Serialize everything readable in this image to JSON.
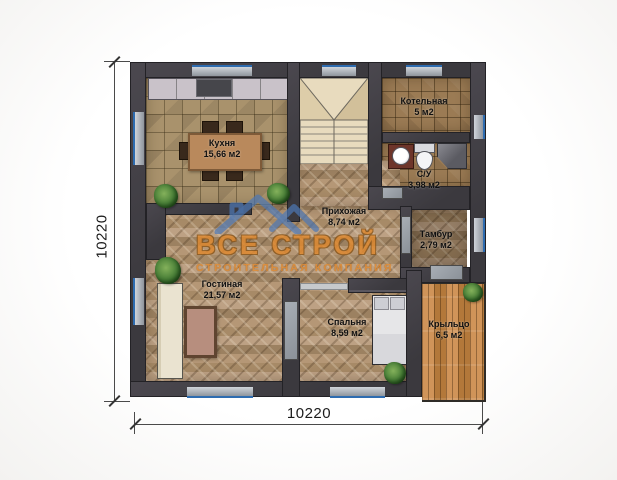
{
  "watermark": {
    "name": "ВСЕ СТРОЙ",
    "tagline": "СТРОИТЕЛЬНАЯ КОМПАНИЯ",
    "text_color": "#e0892f",
    "roof_color": "#4c78b6"
  },
  "dimensions": {
    "bottom_label": "10220",
    "left_label": "10220"
  },
  "rooms": [
    {
      "key": "kitchen",
      "name": "Кухня",
      "area": "15,66 м2"
    },
    {
      "key": "boiler",
      "name": "Котельная",
      "area": "5 м2"
    },
    {
      "key": "bathroom",
      "name": "С/У",
      "area": "3,98 м2"
    },
    {
      "key": "hallway",
      "name": "Прихожая",
      "area": "8,74 м2"
    },
    {
      "key": "vestibule",
      "name": "Тамбур",
      "area": "2,79 м2"
    },
    {
      "key": "living",
      "name": "Гостиная",
      "area": "21,57 м2"
    },
    {
      "key": "bedroom",
      "name": "Спальня",
      "area": "8,59 м2"
    },
    {
      "key": "porch",
      "name": "Крыльцо",
      "area": "6,5 м2"
    }
  ],
  "colors": {
    "wall": "#3f3d42",
    "kitchen_tile": "#a9926c",
    "bath_tile": "#9b7b54",
    "wood_floor": "#b0916e",
    "porch_wood": "#c4884b",
    "stairs": "#e8dbbe",
    "window_glass": "#b7bdc5",
    "window_line": "#2e6cb0"
  }
}
